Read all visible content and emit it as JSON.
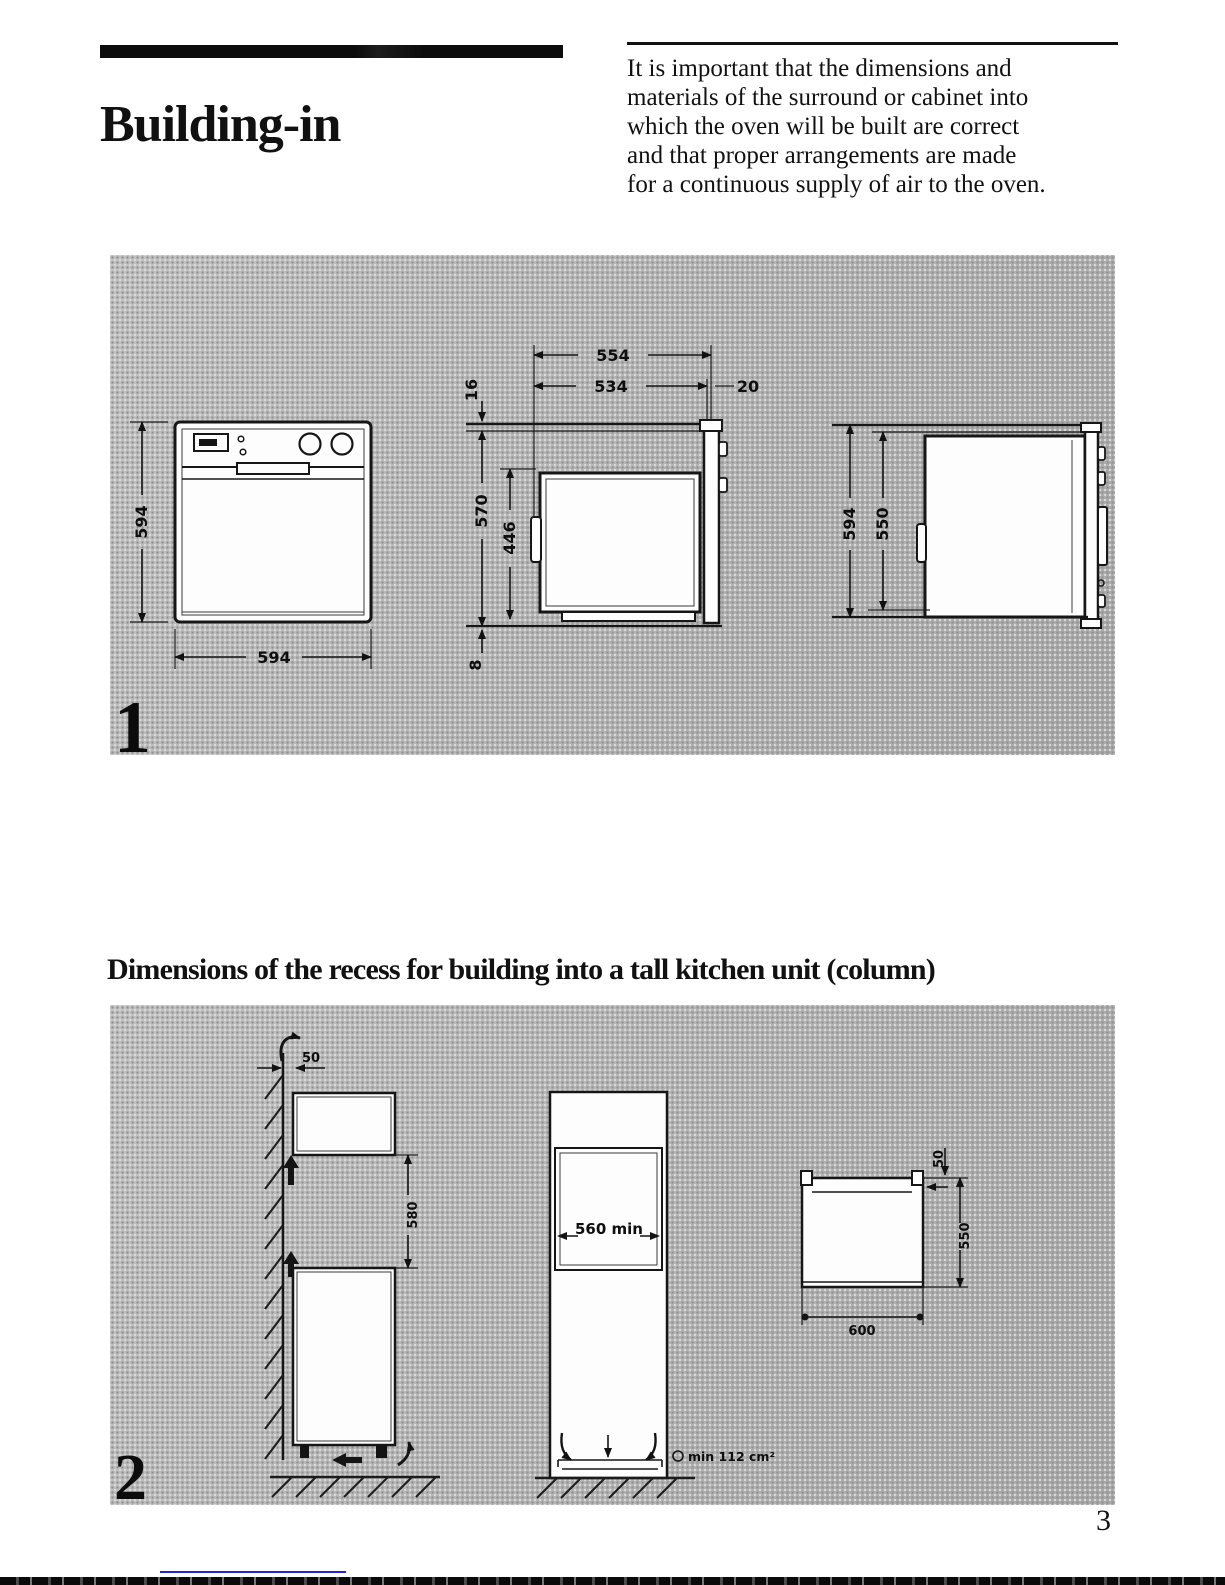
{
  "page": {
    "title": "Building-in",
    "intro_lines": [
      "It is important that the dimensions and",
      "materials of the surround or cabinet into",
      "which the oven will be built are correct",
      "and that proper arrangements are made",
      "for a continuous supply of air to the oven."
    ],
    "section_heading": "Dimensions of the recess for building into a tall kitchen unit (column)",
    "page_number": "3"
  },
  "figure1": {
    "label": "1",
    "front_view": {
      "height": "594",
      "width": "594"
    },
    "side_view": {
      "depth_overall": "554",
      "depth_body": "534",
      "door_projection": "20",
      "top_clearance": "16",
      "height_overall": "570",
      "height_inner": "446",
      "bottom_clearance": "8"
    },
    "rear_view": {
      "height_overall": "594",
      "height_body": "550"
    }
  },
  "figure2": {
    "label": "2",
    "wall_section": {
      "wall_gap": "50",
      "recess_height": "580"
    },
    "column_front": {
      "recess_width": "560 min",
      "vent_area": "min 112 cm²"
    },
    "plan_view": {
      "rear_gap": "50",
      "depth": "550",
      "width": "600"
    }
  }
}
